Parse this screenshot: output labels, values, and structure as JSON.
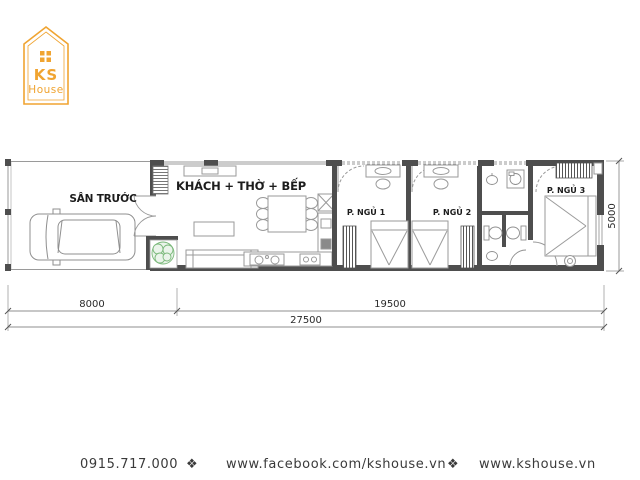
{
  "logo": {
    "brand_line1": "KS",
    "brand_line2": "House",
    "color": "#F0A431",
    "icon": "house-outline-icon"
  },
  "plan": {
    "labels": {
      "front_yard": "SÂN TRƯỚC",
      "living": "KHÁCH + THỜ + BẾP",
      "bedroom1": "P. NGỦ 1",
      "bedroom2": "P. NGỦ 2",
      "bedroom3": "P. NGỦ 3"
    },
    "dimensions": {
      "front_yard_width": "8000",
      "main_width": "19500",
      "total_width": "27500",
      "depth": "5000"
    },
    "furniture_icons": [
      "car-icon",
      "plant-icon",
      "sofa-icon",
      "dining-table-icon",
      "kitchen-stove-icon",
      "kitchen-sink-icon",
      "fridge-icon",
      "bed-icon",
      "wardrobe-icon",
      "dressing-table-icon",
      "toilet-icon",
      "basin-icon",
      "washing-machine-icon"
    ]
  },
  "footer": {
    "phone": "0915.717.000",
    "separator": "❖",
    "facebook_url": "www.facebook.com/kshouse.vn",
    "website_url": "www.kshouse.vn",
    "accent_color": "#E8A33D"
  }
}
